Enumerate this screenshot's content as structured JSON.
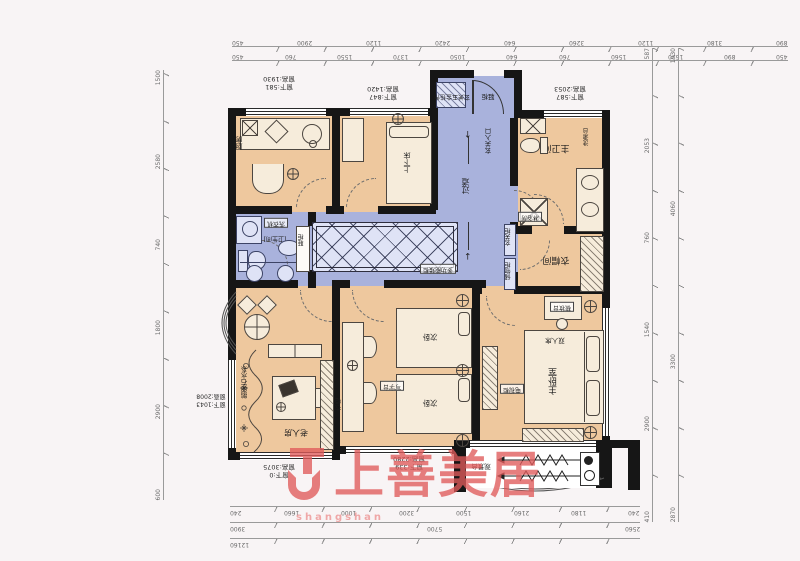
{
  "meta": {
    "bg": "#f8f4f5",
    "wall": "#161616",
    "room": "#eec89e",
    "blue": "#a9b2dc",
    "furn": "#f6ecdb",
    "bfurn": "#dfe3f6",
    "red": "#e05b5b",
    "redlight": "#ef9f9f",
    "line": "#9a9a9a"
  },
  "watermark": {
    "brand": "上善美居",
    "pinyin": "shangshan"
  },
  "icons": {
    "up": "↑",
    "down": "↓"
  },
  "labels": {
    "kitchen": "厨房",
    "bunk_bed": "上下床",
    "hall_hooks": "玄关五金挂件",
    "entry_shoe": "鞋柜",
    "aisle": "过道",
    "entry_col": "玄关入口",
    "hall_cab": "玄关柜",
    "storage_cab": "储物柜",
    "multi_cab": "多功能矮柜",
    "washer": "洗衣机",
    "bath": "[卫生间]",
    "shoe_cab2": "鞋柜",
    "master_bath": "主卫间",
    "wash_table": "洗漱台",
    "shower": "淋浴房",
    "cloak": "衣帽间",
    "master": "主卧室",
    "double_bed": "双人床",
    "dresser": "梳妆台",
    "tv_cab": "电视柜",
    "second_a": "次卧",
    "second_b": "次卧",
    "desk2": "写字台",
    "wardrobe": "衣柜",
    "elder": "老人房",
    "pebble": "鹅卵石水系",
    "view": "观景台"
  },
  "window_notes": {
    "kitchen_h": "窗高:1930",
    "kitchen_b": "窗下:581",
    "kids_h": "窗高:1420",
    "kids_b": "窗下:847",
    "bathtop_h": "窗高:2053",
    "bathtop_b": "窗下:587",
    "left_h": "窗高:2008",
    "left_b": "窗下:1043",
    "elder_h": "窗高:3075",
    "elder_b": "窗下:0",
    "second_h": "窗高:2280",
    "second_b": "窗下:339"
  },
  "dims": {
    "top1": [
      "450",
      "2900",
      "1120",
      "2420",
      "640",
      "3260",
      "1120",
      "3180",
      "890"
    ],
    "top2": [
      "450",
      "760",
      "1550",
      "1370",
      "1050",
      "640",
      "760",
      "1560",
      "1620",
      "890",
      "450"
    ],
    "right1": [
      "587",
      "2053",
      "760",
      "1540",
      "2900",
      "410"
    ],
    "right2": [
      "1930",
      "4060",
      "3300",
      "2870"
    ],
    "bottom1": [
      "240",
      "1660",
      "1000",
      "3200",
      "1500",
      "2160",
      "1180",
      "240"
    ],
    "bottom2": [
      "3900",
      "5700",
      "2560"
    ],
    "bottom3": [
      "12160"
    ],
    "left1": [
      "1500",
      "2580",
      "740",
      "1800",
      "2900",
      "600"
    ]
  }
}
